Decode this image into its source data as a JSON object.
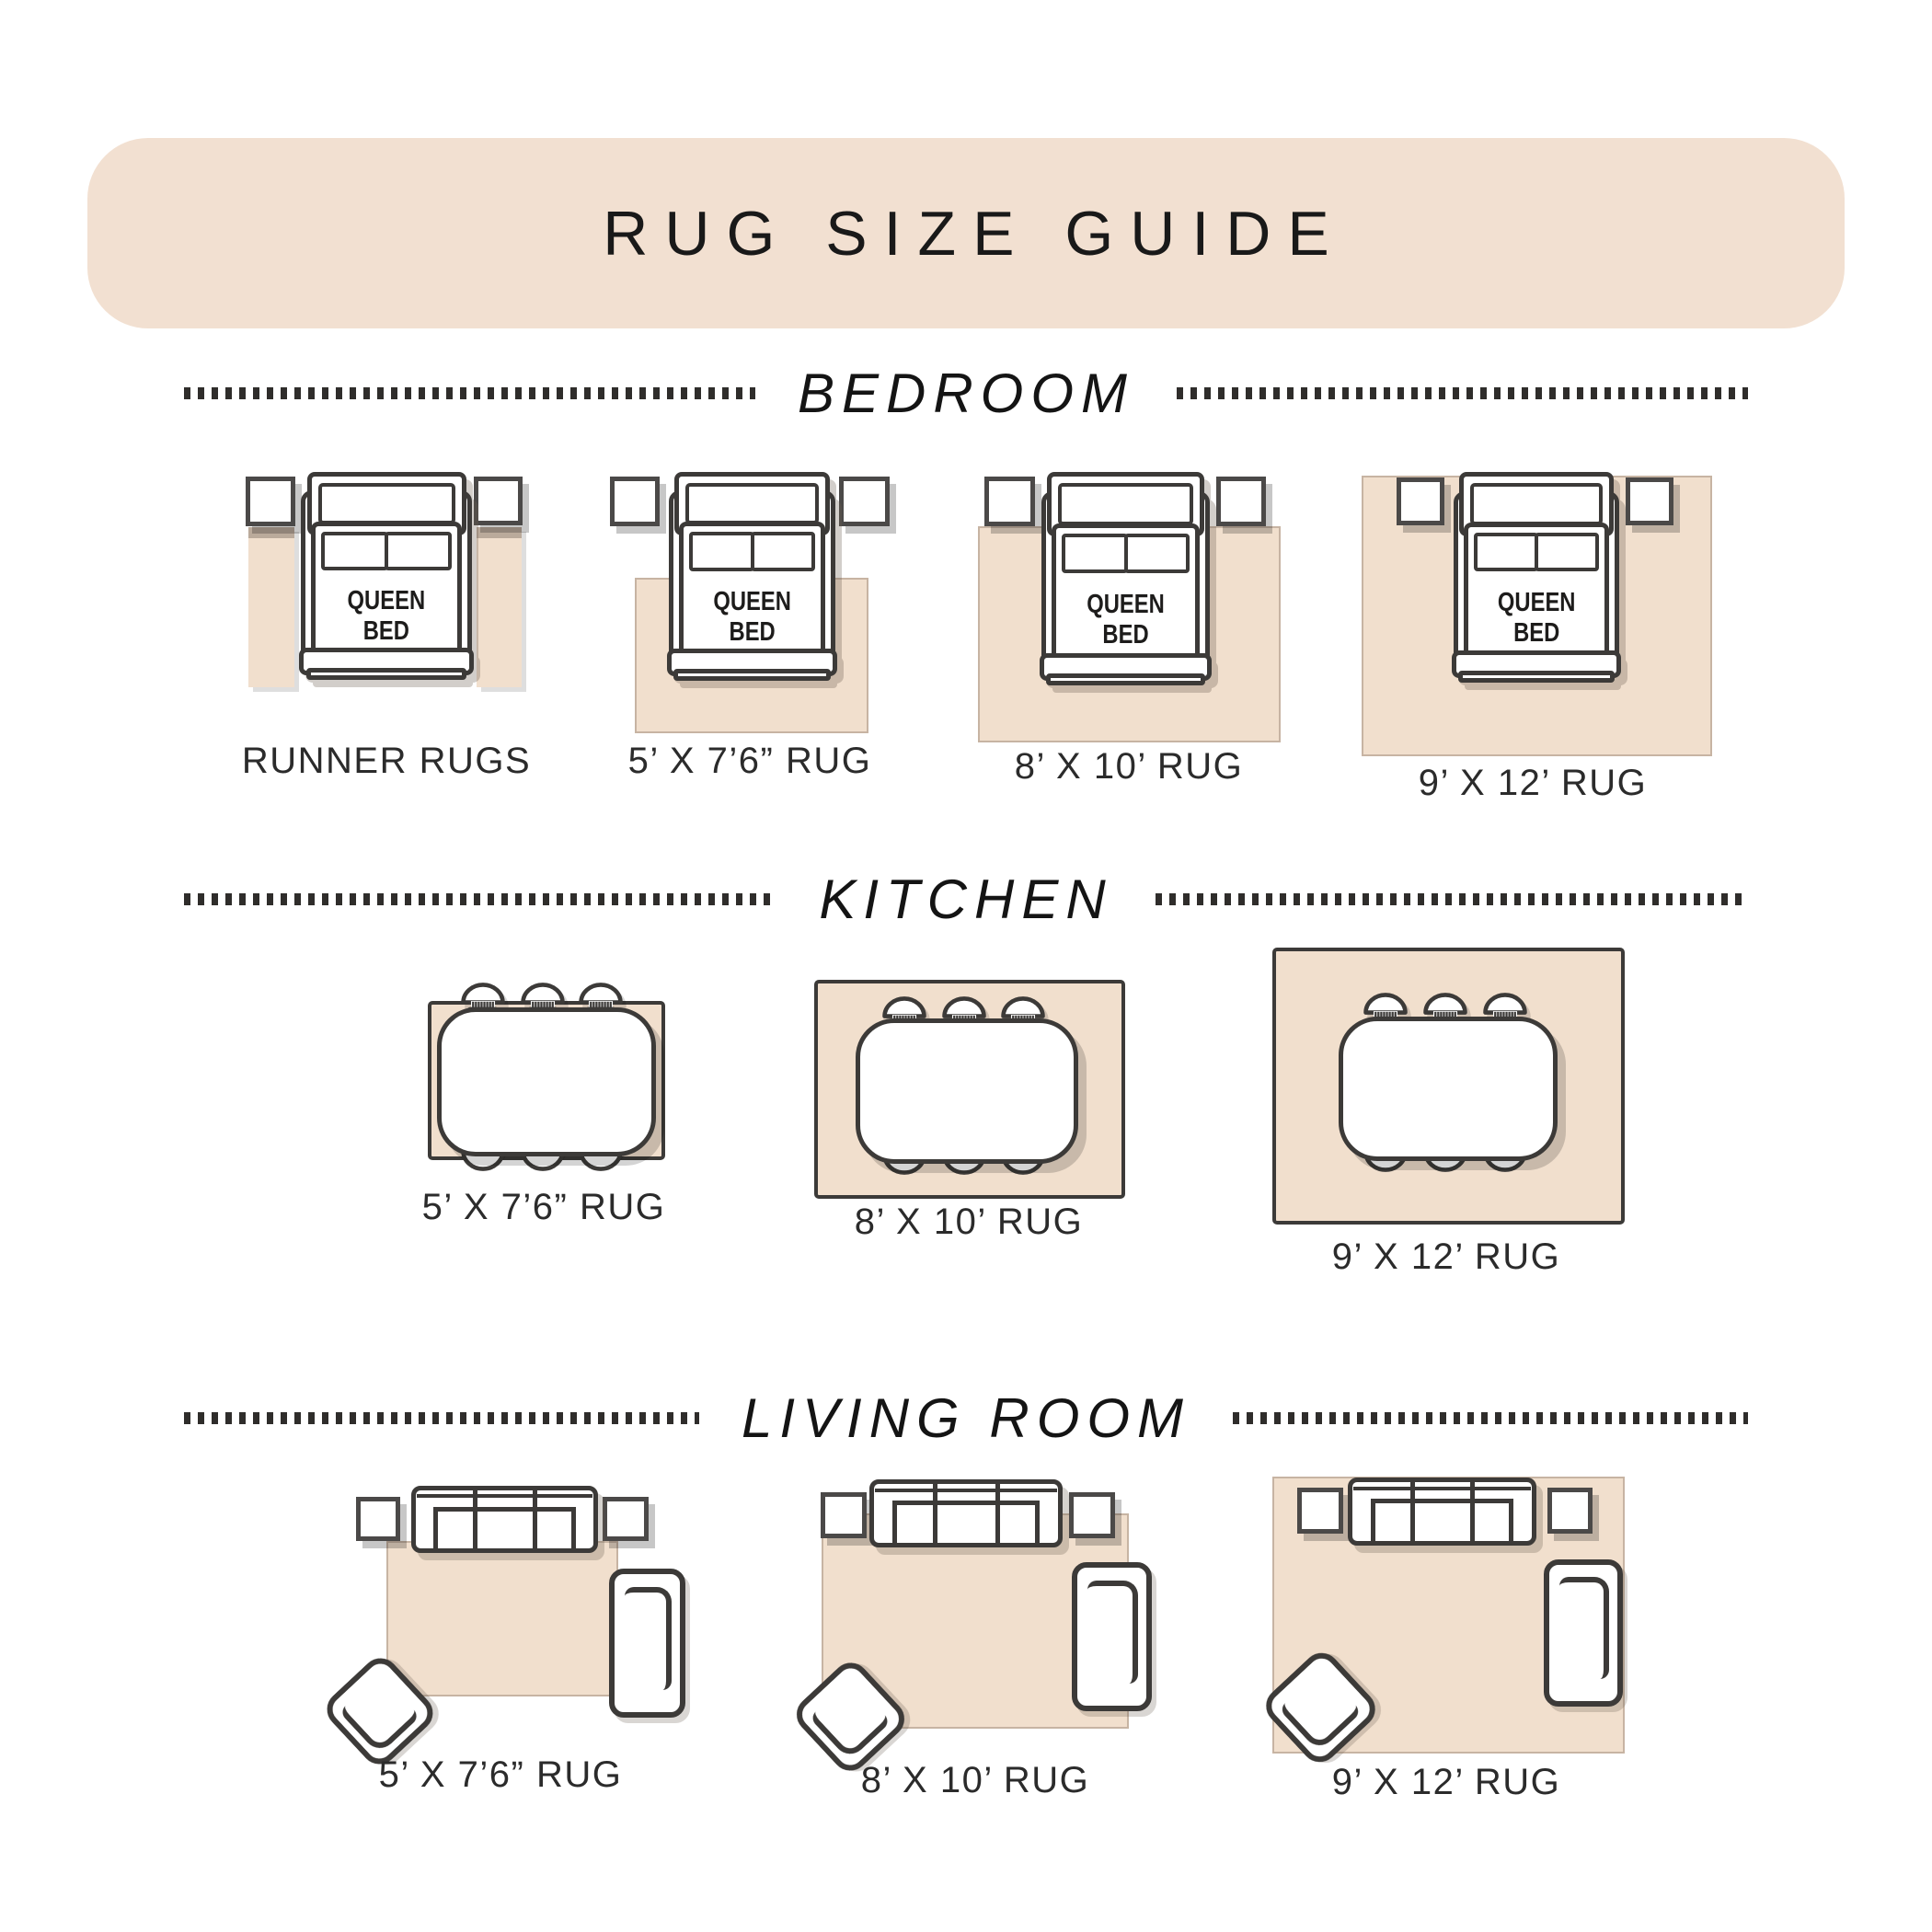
{
  "header": {
    "title": "RUG SIZE GUIDE"
  },
  "labels": {
    "queen_bed": "QUEEN BED"
  },
  "sections": [
    {
      "title": "BEDROOM",
      "items": [
        {
          "label": "RUNNER RUGS"
        },
        {
          "label": "5’ X 7’6” RUG"
        },
        {
          "label": "8’ X 10’ RUG"
        },
        {
          "label": "9’ X 12’ RUG"
        }
      ]
    },
    {
      "title": "KITCHEN",
      "items": [
        {
          "label": "5’ X 7’6” RUG"
        },
        {
          "label": "8’ X 10’ RUG"
        },
        {
          "label": "9’ X 12’ RUG"
        }
      ]
    },
    {
      "title": "LIVING ROOM",
      "items": [
        {
          "label": "5’ X 7’6” RUG"
        },
        {
          "label": "8’ X 10’ RUG"
        },
        {
          "label": "9’ X 12’ RUG"
        }
      ]
    }
  ],
  "colors": {
    "band": "#f2e0d1",
    "beige": "#f1dfcd",
    "line": "#3c3a38",
    "text": "#2b2b2b"
  }
}
